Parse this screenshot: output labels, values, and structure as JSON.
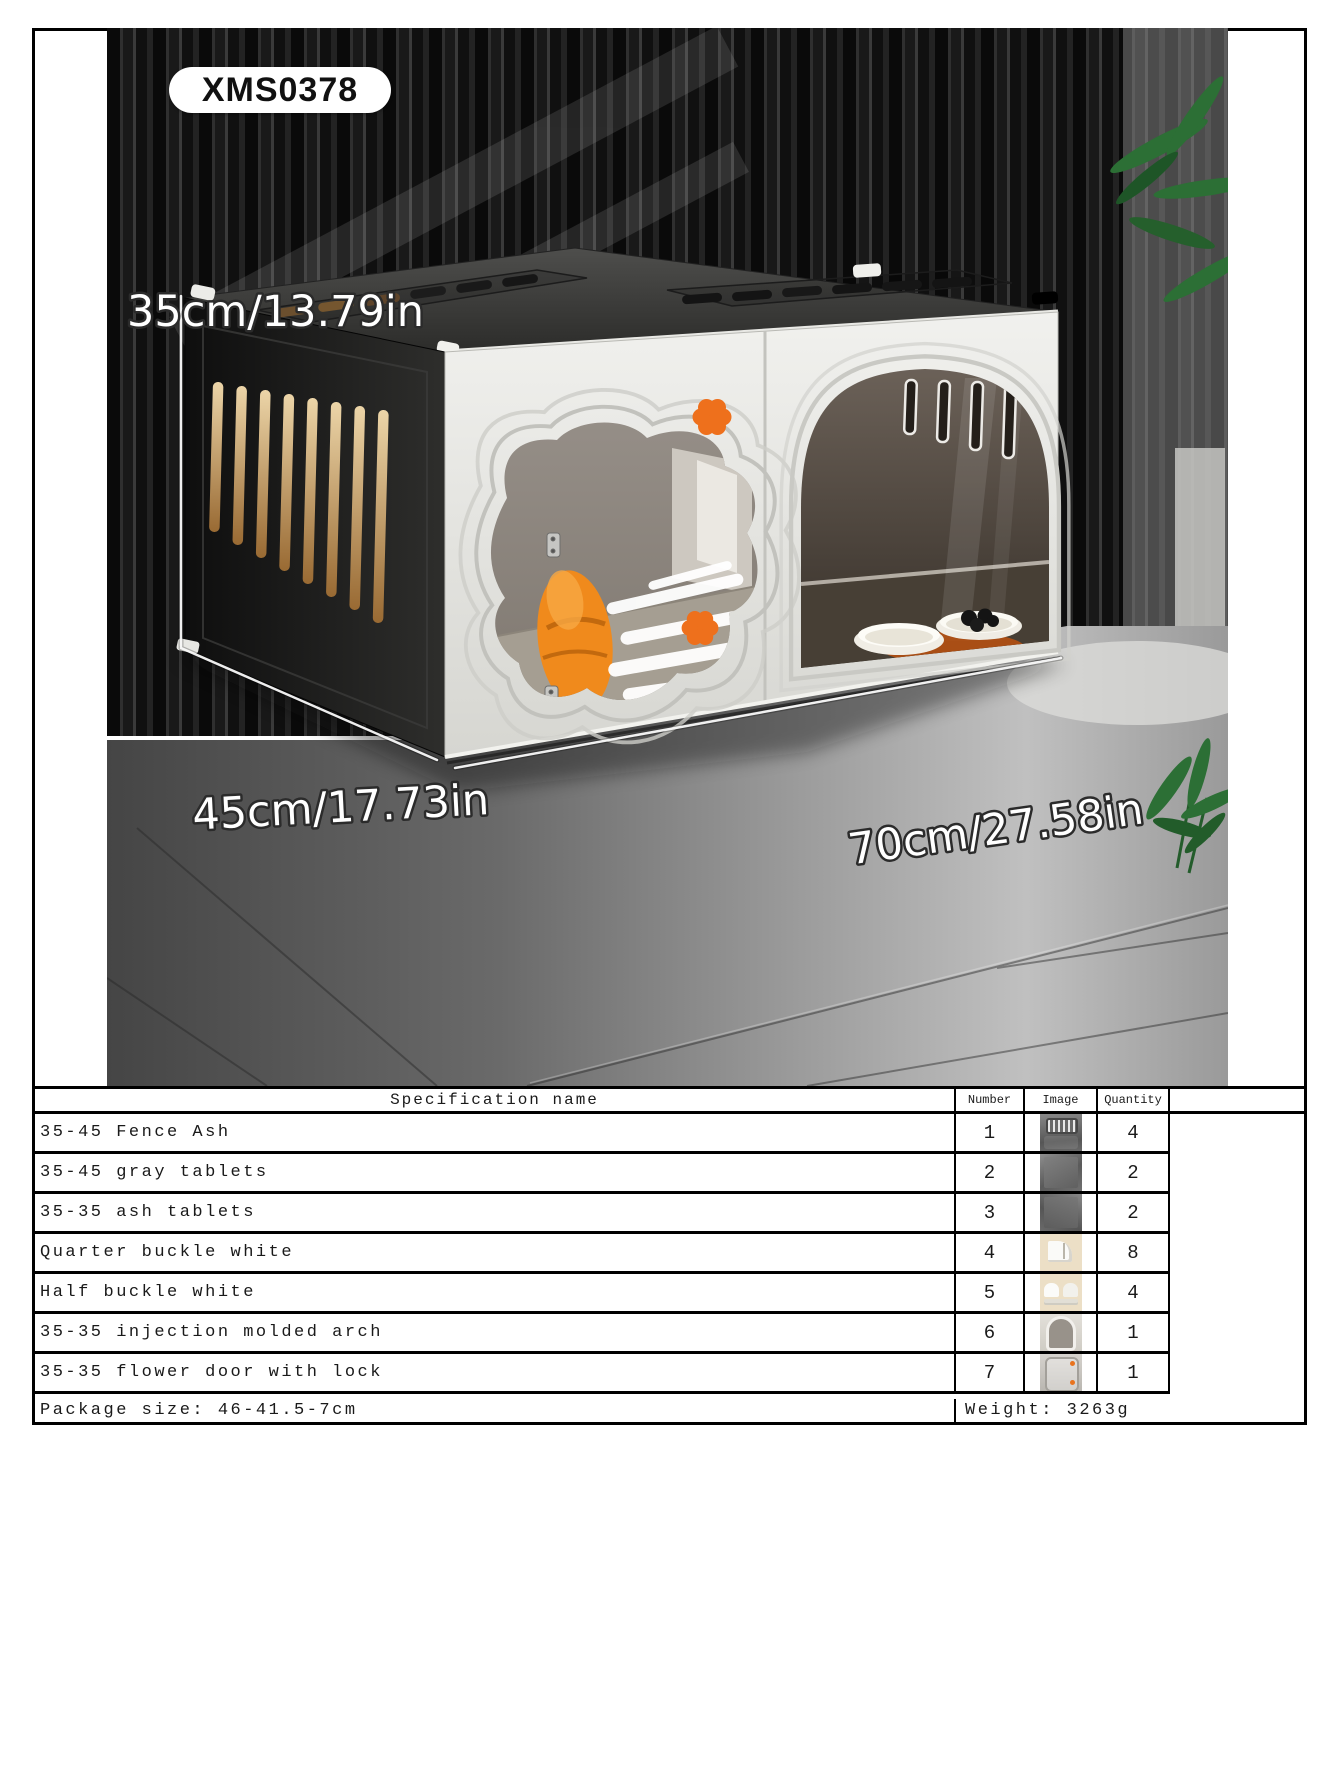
{
  "product": {
    "badge": "XMS0378",
    "dimensions": {
      "height": "35cm/13.79in",
      "depth": "45cm/17.73in",
      "width": "70cm/27.58in"
    },
    "accent_color": "#e8731e",
    "photo_items": [
      "slat-wall",
      "concrete-floor",
      "pet-cage",
      "flower-window",
      "arch-window",
      "cat-cushion",
      "food-bowls",
      "plant-leaves"
    ]
  },
  "spec_table": {
    "border_color": "#000000",
    "headers": {
      "name": "Specification name",
      "number": "Number",
      "image": "Image",
      "quantity": "Quantity"
    },
    "rows": [
      {
        "name": "35-45 Fence Ash",
        "number": "1",
        "image": "fence-ash-thumbnail",
        "quantity": "4"
      },
      {
        "name": "35-45 gray tablets",
        "number": "2",
        "image": "gray-tablet-thumbnail",
        "quantity": "2"
      },
      {
        "name": "35-35 ash tablets",
        "number": "3",
        "image": "ash-tablet-thumbnail",
        "quantity": "2"
      },
      {
        "name": "Quarter buckle white",
        "number": "4",
        "image": "quarter-buckle-thumbnail",
        "quantity": "8"
      },
      {
        "name": "Half buckle white",
        "number": "5",
        "image": "half-buckle-thumbnail",
        "quantity": "4"
      },
      {
        "name": "35-35 injection molded arch",
        "number": "6",
        "image": "arch-thumbnail",
        "quantity": "1"
      },
      {
        "name": "35-35 flower door with lock",
        "number": "7",
        "image": "flower-door-thumbnail",
        "quantity": "1"
      }
    ],
    "footer": {
      "package_size": "Package size: 46-41.5-7cm",
      "weight": "Weight: 3263g"
    }
  }
}
